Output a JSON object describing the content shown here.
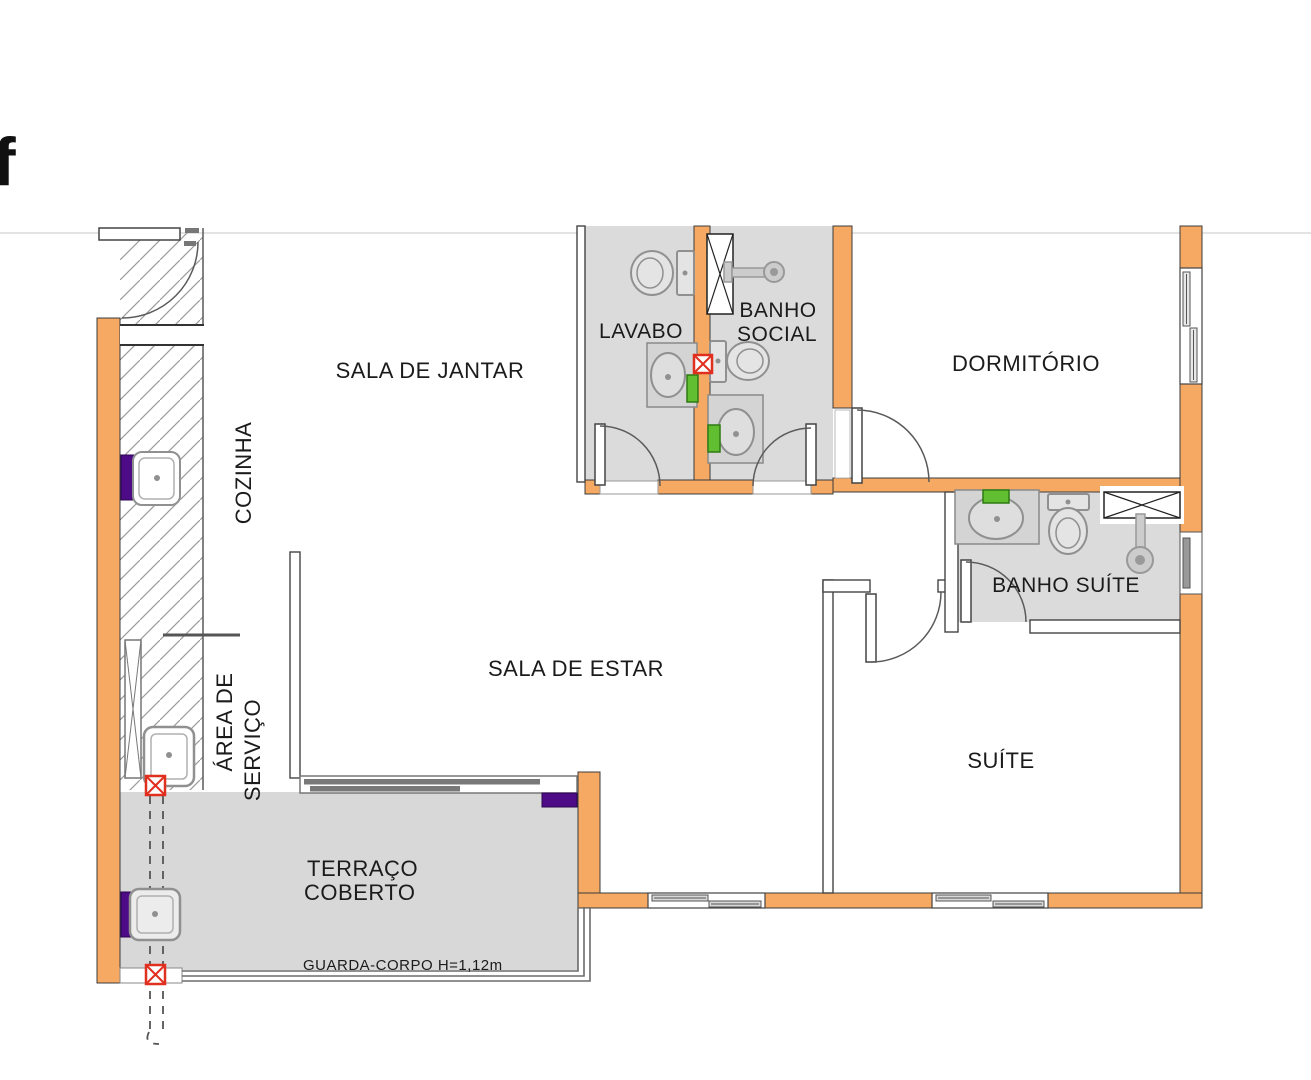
{
  "page": {
    "logo_fragment": "f",
    "viewer_rule_color": "#e3e3e3"
  },
  "floor_plan": {
    "rooms": [
      {
        "id": "sala-de-jantar",
        "lines": [
          "SALA DE JANTAR"
        ]
      },
      {
        "id": "cozinha",
        "lines": [
          "COZINHA"
        ],
        "text_rotation": -90
      },
      {
        "id": "lavabo",
        "lines": [
          "LAVABO"
        ]
      },
      {
        "id": "banho-social",
        "lines": [
          "BANHO",
          "SOCIAL"
        ]
      },
      {
        "id": "dormitorio",
        "lines": [
          "DORMITÓRIO"
        ]
      },
      {
        "id": "banho-suite",
        "lines": [
          "BANHO SUÍTE"
        ]
      },
      {
        "id": "sala-de-estar",
        "lines": [
          "SALA DE ESTAR"
        ]
      },
      {
        "id": "area-de-servico",
        "lines": [
          "ÁREA DE",
          "SERVIÇO"
        ],
        "text_rotation": -90
      },
      {
        "id": "suite",
        "lines": [
          "SUÍTE"
        ]
      },
      {
        "id": "terraco-coberto",
        "lines": [
          "TERRAÇO",
          "COBERTO"
        ]
      }
    ],
    "annotations": {
      "guard_rail_label": "GUARDA-CORPO H=1,12m"
    },
    "fixtures": [
      {
        "icon": "toilet-icon",
        "count": 3
      },
      {
        "icon": "washbasin-icon",
        "count": 3
      },
      {
        "icon": "kitchen-sink-icon",
        "count": 1
      },
      {
        "icon": "laundry-tank-icon",
        "count": 1
      },
      {
        "icon": "terrace-sink-icon",
        "count": 1
      },
      {
        "icon": "shower-head-icon",
        "count": 2
      },
      {
        "icon": "ventilation-shaft-icon",
        "count": 2
      },
      {
        "icon": "door-swing-icon",
        "count": 6
      },
      {
        "icon": "sliding-door-icon",
        "count": 1
      },
      {
        "icon": "window-icon",
        "count": 5
      },
      {
        "icon": "drain-marker-icon",
        "count": 3
      },
      {
        "icon": "plumbing-riser-icon",
        "count": 1
      }
    ],
    "colors": {
      "wall_orange": "#F5A962",
      "floor_gray": "#DBDBDB",
      "counter_gray": "#D4D4D4",
      "fixture_line": "#909090",
      "wall_outline": "#3C3C3C",
      "accent_purple": "#4D0C86",
      "accent_green": "#61BE31",
      "marker_red": "#E12F1F",
      "rail_gray": "#6B6B6B"
    }
  }
}
